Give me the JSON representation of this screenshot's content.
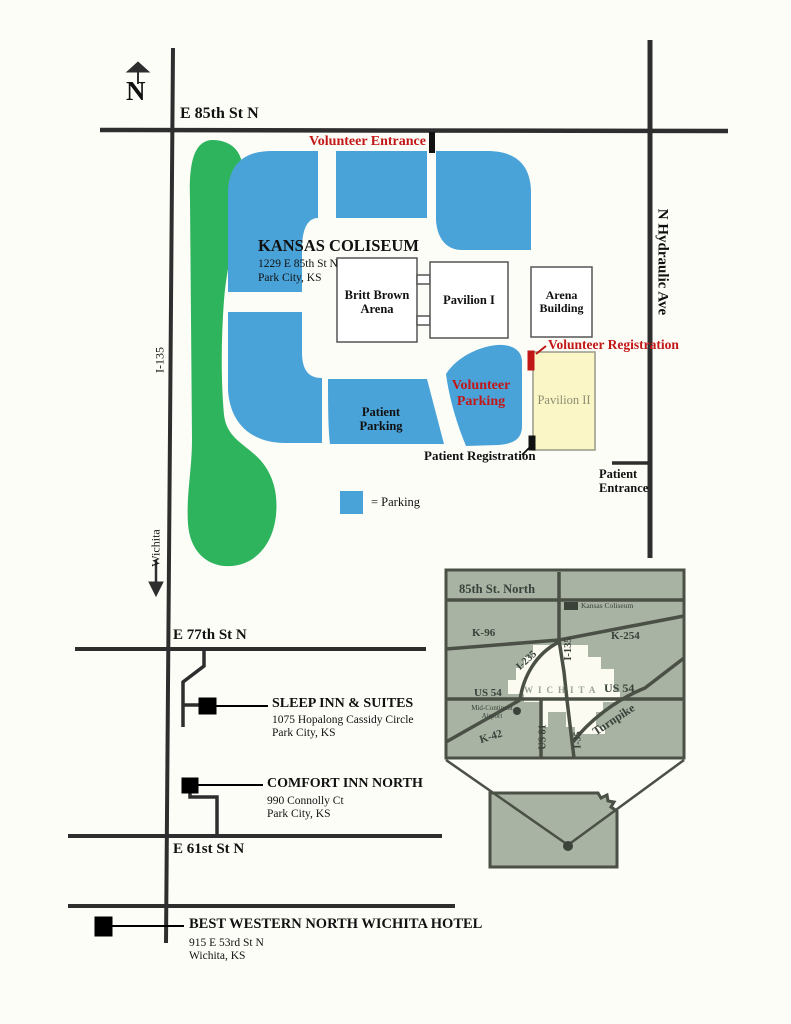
{
  "map": {
    "compass": "N",
    "streets": {
      "e85th": "E 85th St N",
      "hydraulic": "N Hydraulic Ave",
      "i135": "I-135",
      "wichita_arrow": "Wichita",
      "e77th": "E 77th St N",
      "e61st": "E 61st St N"
    },
    "venue": {
      "name": "KANSAS COLISEUM",
      "address1": "1229 E 85th St N",
      "address2": "Park City, KS"
    },
    "buildings": {
      "britt_brown_1": "Britt Brown",
      "britt_brown_2": "Arena",
      "pavilion1": "Pavilion I",
      "arena_1": "Arena",
      "arena_2": "Building",
      "pavilion2": "Pavilion II"
    },
    "annotations": {
      "volunteer_entrance": "Volunteer Entrance",
      "volunteer_registration": "Volunteer Registration",
      "volunteer_parking_1": "Volunteer",
      "volunteer_parking_2": "Parking",
      "patient_parking_1": "Patient",
      "patient_parking_2": "Parking",
      "patient_registration": "Patient Registration",
      "patient_entrance_1": "Patient",
      "patient_entrance_2": "Entrance"
    },
    "legend": {
      "parking": "= Parking"
    }
  },
  "hotels": [
    {
      "name": "SLEEP INN & SUITES",
      "address1": "1075 Hopalong Cassidy Circle",
      "address2": "Park City, KS"
    },
    {
      "name": "COMFORT INN NORTH",
      "address1": "990 Connolly Ct",
      "address2": "Park City, KS"
    },
    {
      "name": "BEST WESTERN NORTH WICHITA HOTEL",
      "address1": "915 E 53rd St N",
      "address2": "Wichita, KS"
    }
  ],
  "inset": {
    "street_85th": "85th St. North",
    "coliseum": "Kansas Coliseum",
    "k96": "K-96",
    "k254": "K-254",
    "i235": "I-235",
    "i135": "I-135",
    "us54_left": "US 54",
    "us54_right": "US 54",
    "airport_1": "Mid-Continent",
    "airport_2": "Airport",
    "k42": "K-42",
    "us81": "US 81",
    "i35": "I-35",
    "turnpike": "Turnpike",
    "city": "WICHITA"
  },
  "colors": {
    "parking_blue": "#4aa3d8",
    "median_green": "#2fb45e",
    "pavilion2_fill": "#faf6c6",
    "accent_red": "#c21717",
    "road_dark": "#2e2e2e",
    "inset_bg": "#a9b3a3",
    "inset_road": "#4a5045"
  }
}
